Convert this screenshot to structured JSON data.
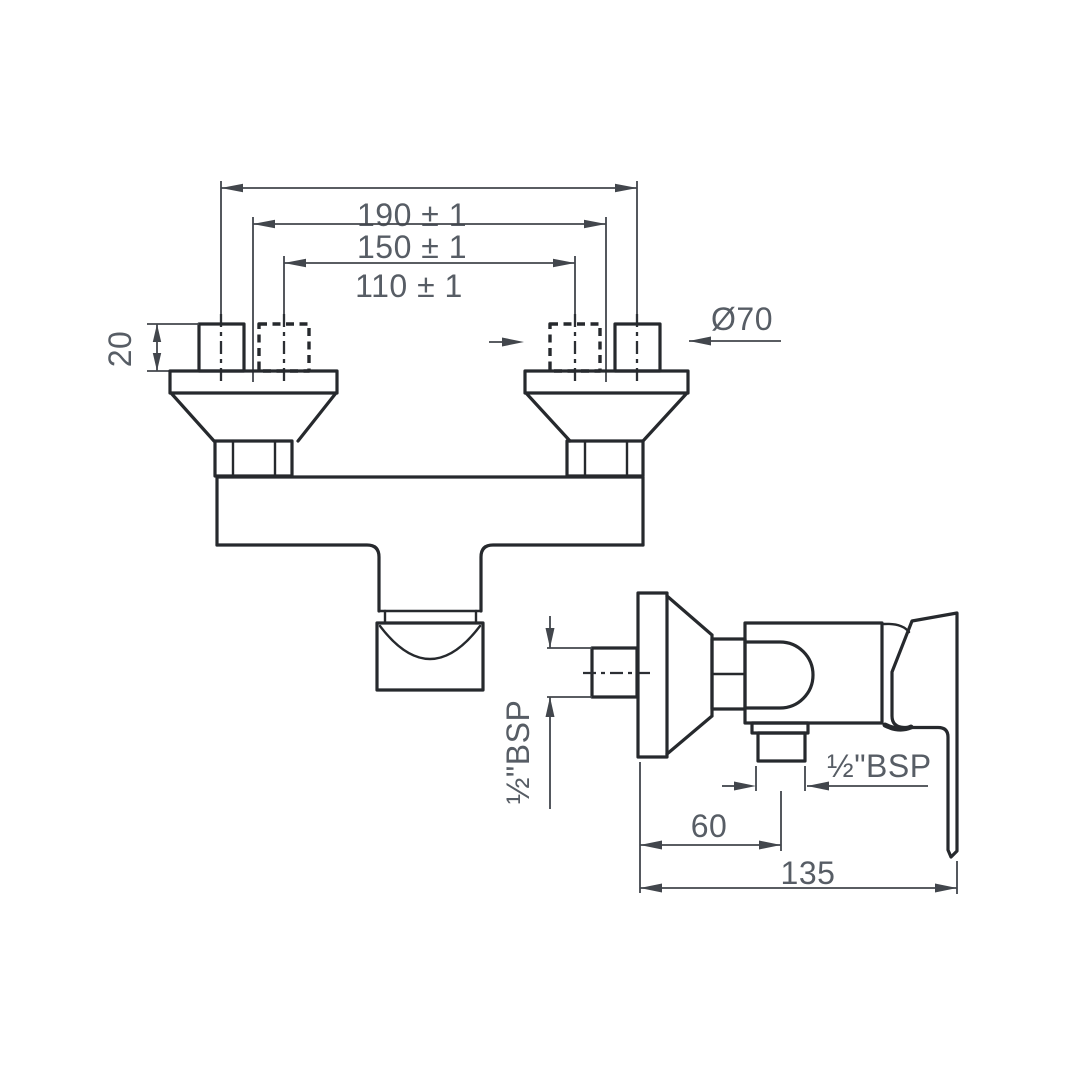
{
  "colors": {
    "object_line": "#26292d",
    "dimension_line": "#42464c",
    "dimension_text": "#575d65",
    "background": "#ffffff"
  },
  "front_view": {
    "dim_span_outer": "190 ± 1",
    "dim_span_mid": "150 ± 1",
    "dim_span_inner": "110 ± 1",
    "dim_connector_height": "20",
    "dim_flange_diameter": "Ø70"
  },
  "side_view": {
    "dim_inlet_thread": "½\"BSP",
    "dim_outlet_thread": "½\"BSP",
    "dim_wall_to_outlet": "60",
    "dim_overall_depth": "135"
  }
}
